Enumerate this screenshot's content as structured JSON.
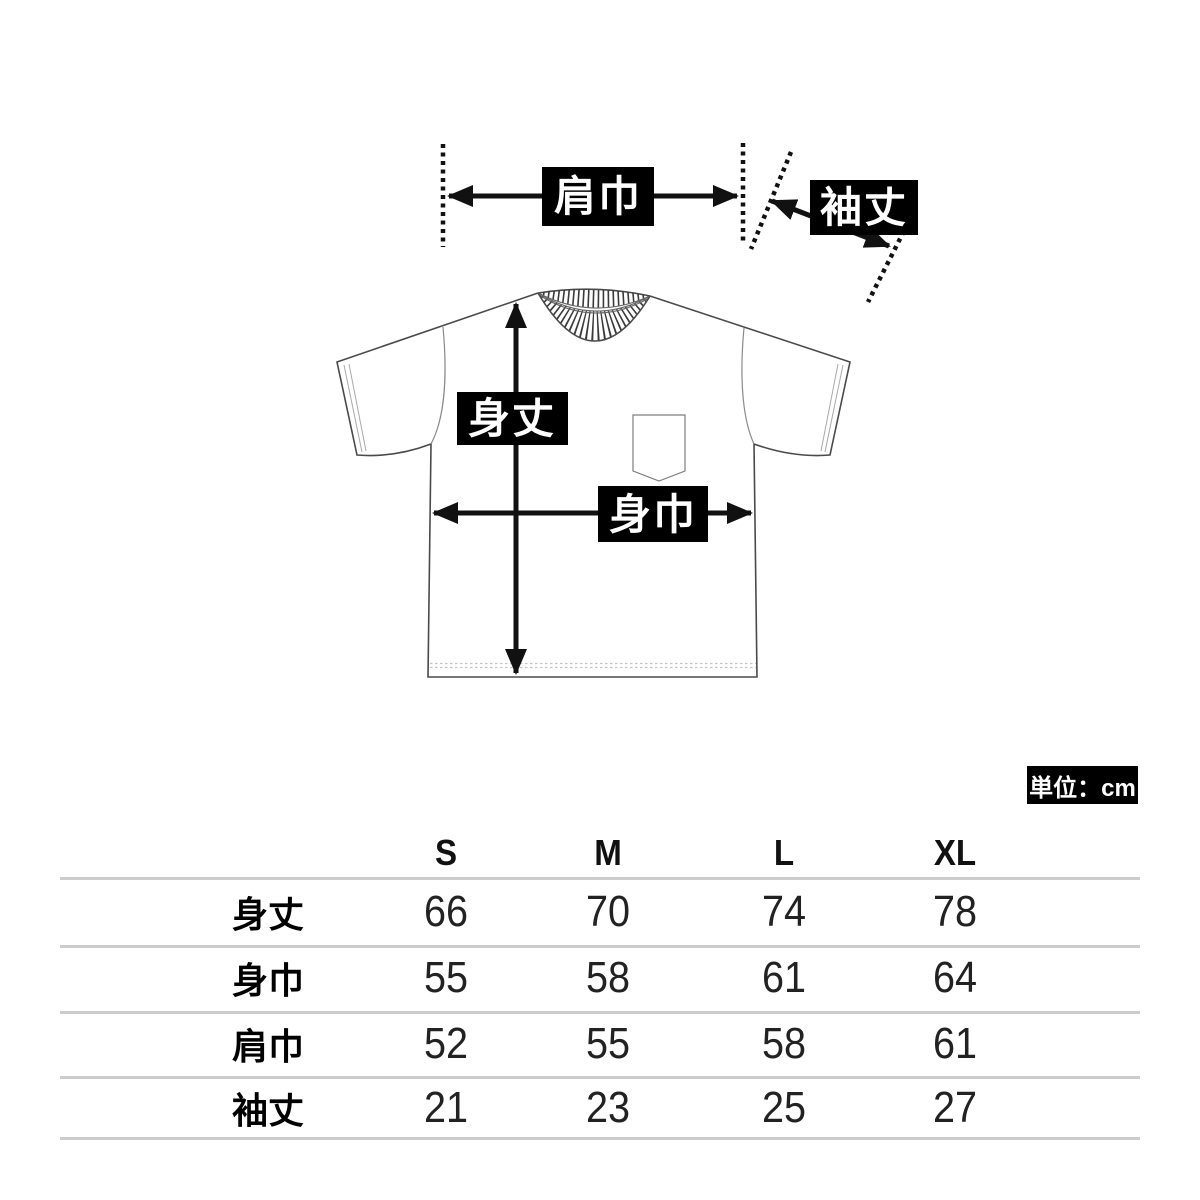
{
  "annotations": {
    "shoulder_width": "肩巾",
    "sleeve_length": "袖丈",
    "body_length": "身丈",
    "body_width": "身巾",
    "unit": "単位：cm"
  },
  "size_table": {
    "columns": [
      "S",
      "M",
      "L",
      "XL"
    ],
    "rows": [
      {
        "label": "身丈",
        "values": [
          "66",
          "70",
          "74",
          "78"
        ]
      },
      {
        "label": "身巾",
        "values": [
          "55",
          "58",
          "61",
          "64"
        ]
      },
      {
        "label": "肩巾",
        "values": [
          "52",
          "55",
          "58",
          "61"
        ]
      },
      {
        "label": "袖丈",
        "values": [
          "21",
          "23",
          "25",
          "27"
        ]
      }
    ]
  },
  "colors": {
    "ink": "#111111",
    "label-bg": "#000000",
    "label-text": "#ffffff",
    "outline": "#4a4a4a",
    "table-line": "#cccccc",
    "text": "#1a1a1a"
  }
}
